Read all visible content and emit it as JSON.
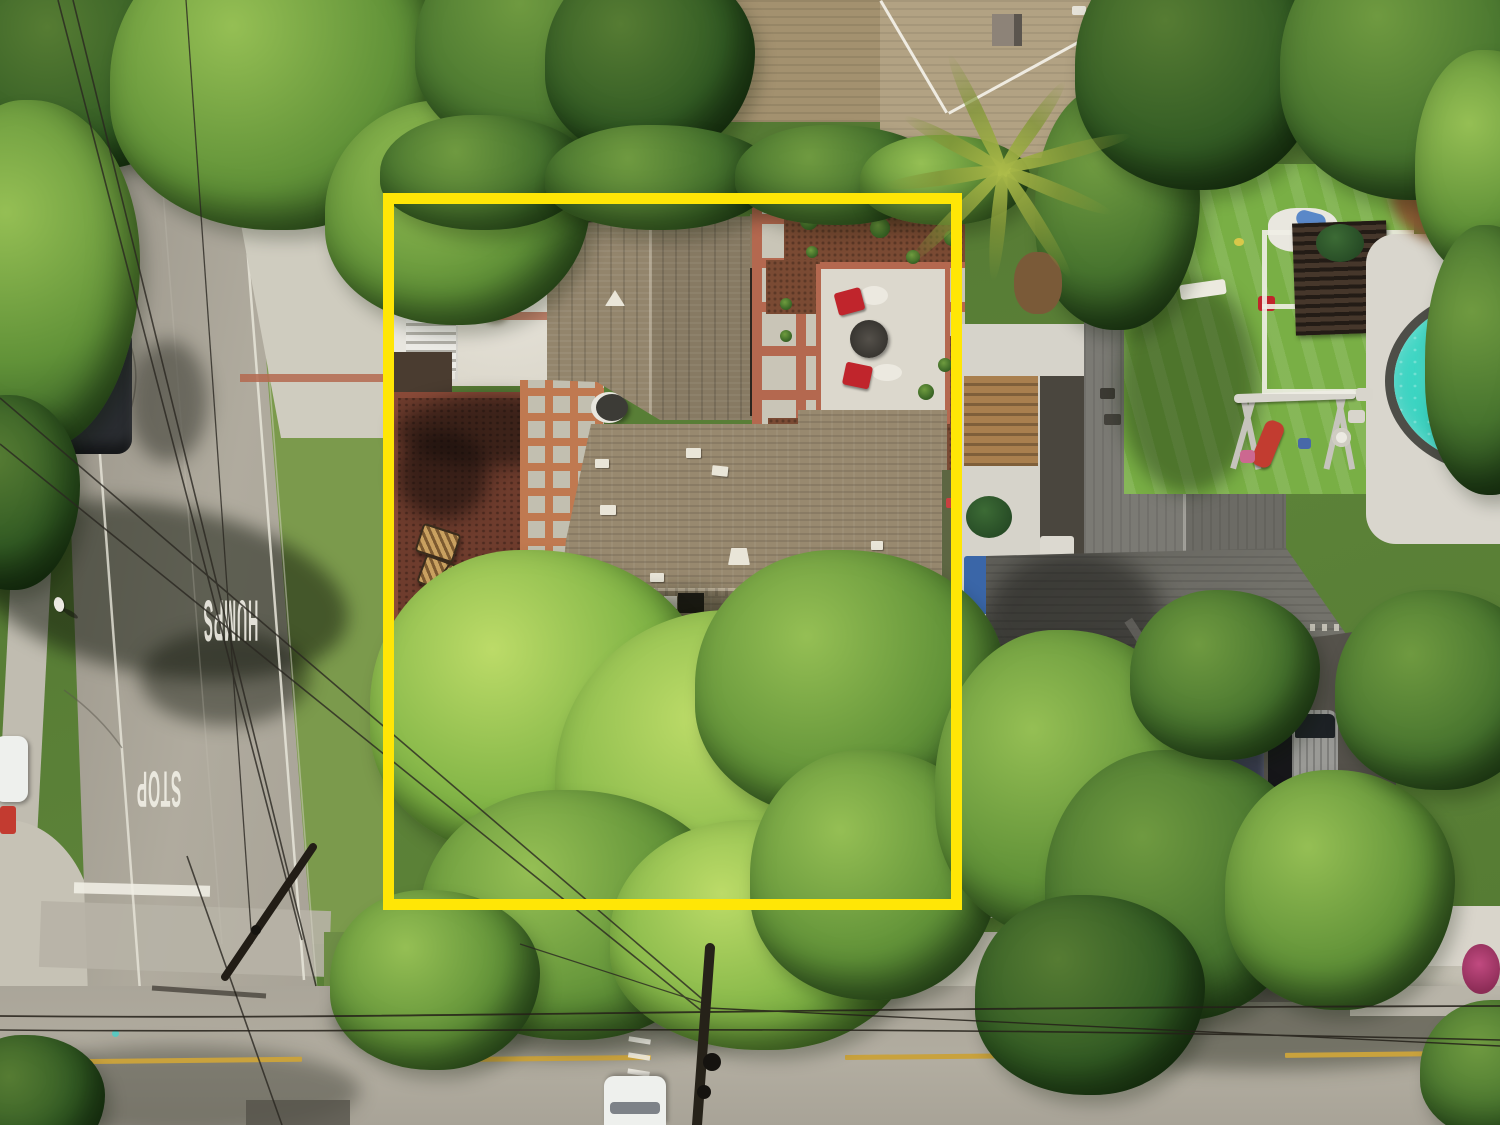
{
  "road_markings": {
    "stop": "STOP",
    "humps": "HUMPS"
  },
  "colors": {
    "boundary_yellow": "#ffe606",
    "marking_white": "#f1efe6",
    "lane_yellow": "#c9a23d",
    "road_asphalt": "#a49f93",
    "concrete": "#d7d3c6",
    "brick_red": "#b4684f",
    "mulch_red_brown": "#6e3c2d",
    "garden_mulch": "#7a4a33",
    "roof_brown": "#98896f",
    "roof_brown_tall": "#93856c",
    "roof_gray": "#73726b",
    "roof_gray_tall": "#7b7a74",
    "roof_tan_top": "#a3916f",
    "turf_green": "#79af45",
    "grass_green": "#7b9a4c",
    "pool_turquoise": "#3bd6c3",
    "red_chair": "#c0252c",
    "red_slide": "#c23c30",
    "car_dark": "#2f3337",
    "car_white": "#eef0ed",
    "wood_tan": "#a97f4e",
    "bougainvillea_pink": "#c14a80",
    "white_wall": "#d6d3ca"
  }
}
